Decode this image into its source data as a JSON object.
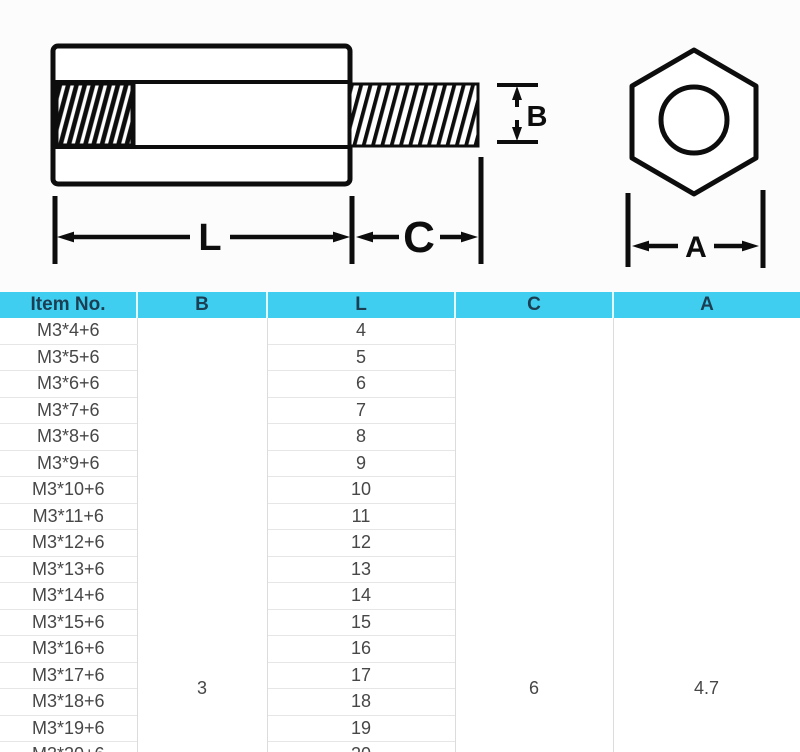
{
  "diagram": {
    "side_view": {
      "label_l": "L",
      "label_c": "C",
      "label_b": "B"
    },
    "end_view": {
      "label_a": "A"
    }
  },
  "table": {
    "headers": [
      "Item No.",
      "B",
      "L",
      "C",
      "A"
    ],
    "rows": [
      {
        "item": "M3*4+6",
        "l": "4"
      },
      {
        "item": "M3*5+6",
        "l": "5"
      },
      {
        "item": "M3*6+6",
        "l": "6"
      },
      {
        "item": "M3*7+6",
        "l": "7"
      },
      {
        "item": "M3*8+6",
        "l": "8"
      },
      {
        "item": "M3*9+6",
        "l": "9"
      },
      {
        "item": "M3*10+6",
        "l": "10"
      },
      {
        "item": "M3*11+6",
        "l": "11"
      },
      {
        "item": "M3*12+6",
        "l": "12"
      },
      {
        "item": "M3*13+6",
        "l": "13"
      },
      {
        "item": "M3*14+6",
        "l": "14"
      },
      {
        "item": "M3*15+6",
        "l": "15"
      },
      {
        "item": "M3*16+6",
        "l": "16"
      },
      {
        "item": "M3*17+6",
        "l": "17"
      },
      {
        "item": "M3*18+6",
        "l": "18"
      },
      {
        "item": "M3*19+6",
        "l": "19"
      },
      {
        "item": "M3*20+6",
        "l": "20"
      }
    ],
    "merged": {
      "b": "3",
      "c": "6",
      "a": "4.7"
    }
  },
  "colors": {
    "header_bg": "#3fcef0",
    "header_text": "#1c3e52",
    "cell_text": "#474747",
    "row_border": "#e6e6e6",
    "column_border": "#dcdcdc",
    "line_color": "#0d0d0d",
    "drawing_bg": "#fcfcfc"
  }
}
